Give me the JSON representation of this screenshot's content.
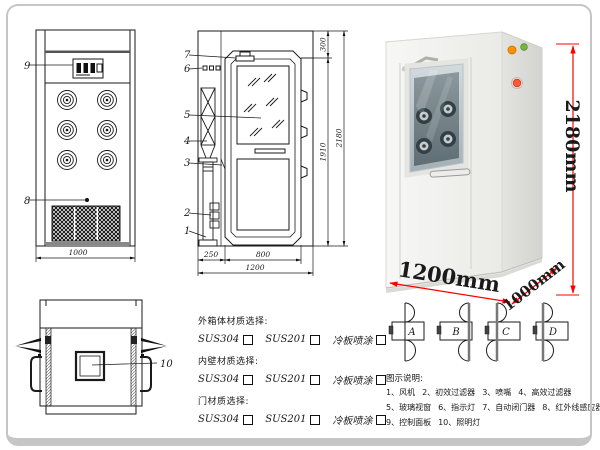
{
  "front_view": {
    "label_control_panel": "9",
    "label_sensor": "8",
    "dim_width": "1000"
  },
  "side_view": {
    "part_labels": [
      "7",
      "6",
      "5",
      "4",
      "3",
      "2",
      "1"
    ],
    "dim_door_offset": "250",
    "dim_door_width": "800",
    "dim_total_width": "1200",
    "dim_top": "300",
    "dim_door_height": "1910",
    "dim_total_height": "2180"
  },
  "top_view": {
    "label_light": "10"
  },
  "photo": {
    "dim_height": "2180mm",
    "dim_width": "1200mm",
    "dim_depth": "1000mm",
    "dim_color": "#ff0000",
    "indicator_lights": [
      "#ff9100",
      "#7cb342",
      "#ff5a36"
    ]
  },
  "materials": {
    "sections": [
      {
        "title": "外箱体材质选择:",
        "options": [
          "SUS304",
          "SUS201",
          "冷板喷涂"
        ]
      },
      {
        "title": "内壁材质选择:",
        "options": [
          "SUS304",
          "SUS201",
          "冷板喷涂"
        ]
      },
      {
        "title": "门材质选择:",
        "options": [
          "SUS304",
          "SUS201",
          "冷板喷涂"
        ]
      }
    ]
  },
  "door_options": {
    "labels": [
      "A",
      "B",
      "C",
      "D"
    ]
  },
  "legend": {
    "title": "图示说明:",
    "items": [
      "1、风机",
      "2、初效过滤器",
      "3、喷嘴",
      "4、高效过滤器",
      "5、玻璃视窗",
      "6、指示灯",
      "7、自动闭门器",
      "8、红外线感应器",
      "9、控制面板",
      "10、照明灯"
    ]
  }
}
